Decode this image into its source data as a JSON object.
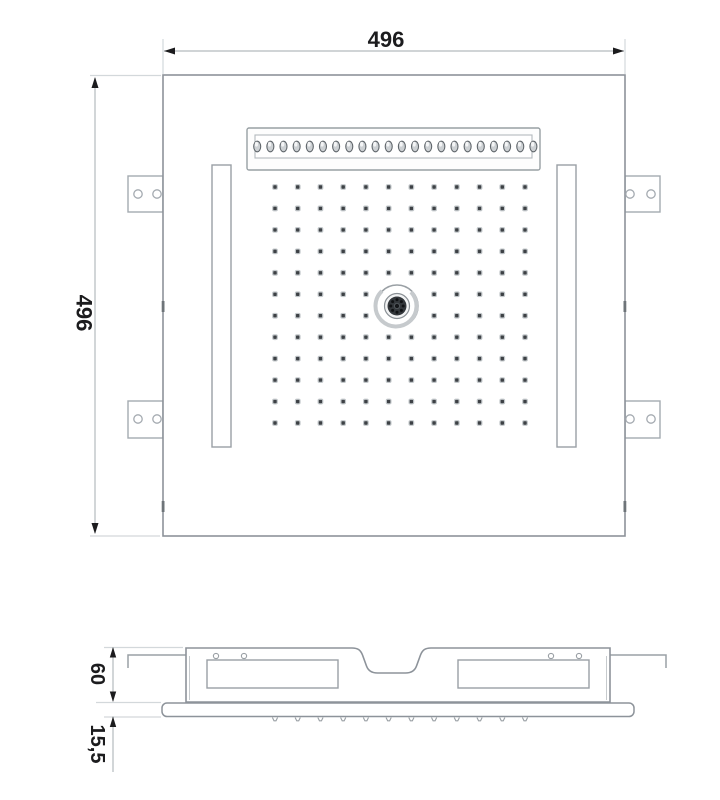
{
  "dimensions": {
    "top_width_label": "496",
    "left_height_label": "496",
    "profile_height_label": "60",
    "panel_thickness_label": "15,5"
  },
  "top_view": {
    "waterfall_nozzle_count": 22,
    "spray_grid": {
      "cols": 12,
      "rows": 12,
      "center_skip": true
    },
    "center_jet_ring_dots": 8,
    "mounting_tab_count": 4,
    "led_strip_count": 2
  },
  "side_view": {
    "nozzle_tick_count": 12
  },
  "colors": {
    "outline": "#8d939a",
    "secondary_line": "#a4aab0",
    "extension_line": "#d3d8db",
    "dimension_line": "#b4babe",
    "text": "#1c1c1e",
    "nozzle_dot": "#3d4145",
    "nozzle_halo": "#c2c7ca",
    "oval_fill": "#cdd1d4",
    "oval_stroke": "#60666b",
    "jet_dark": "#33373b"
  }
}
